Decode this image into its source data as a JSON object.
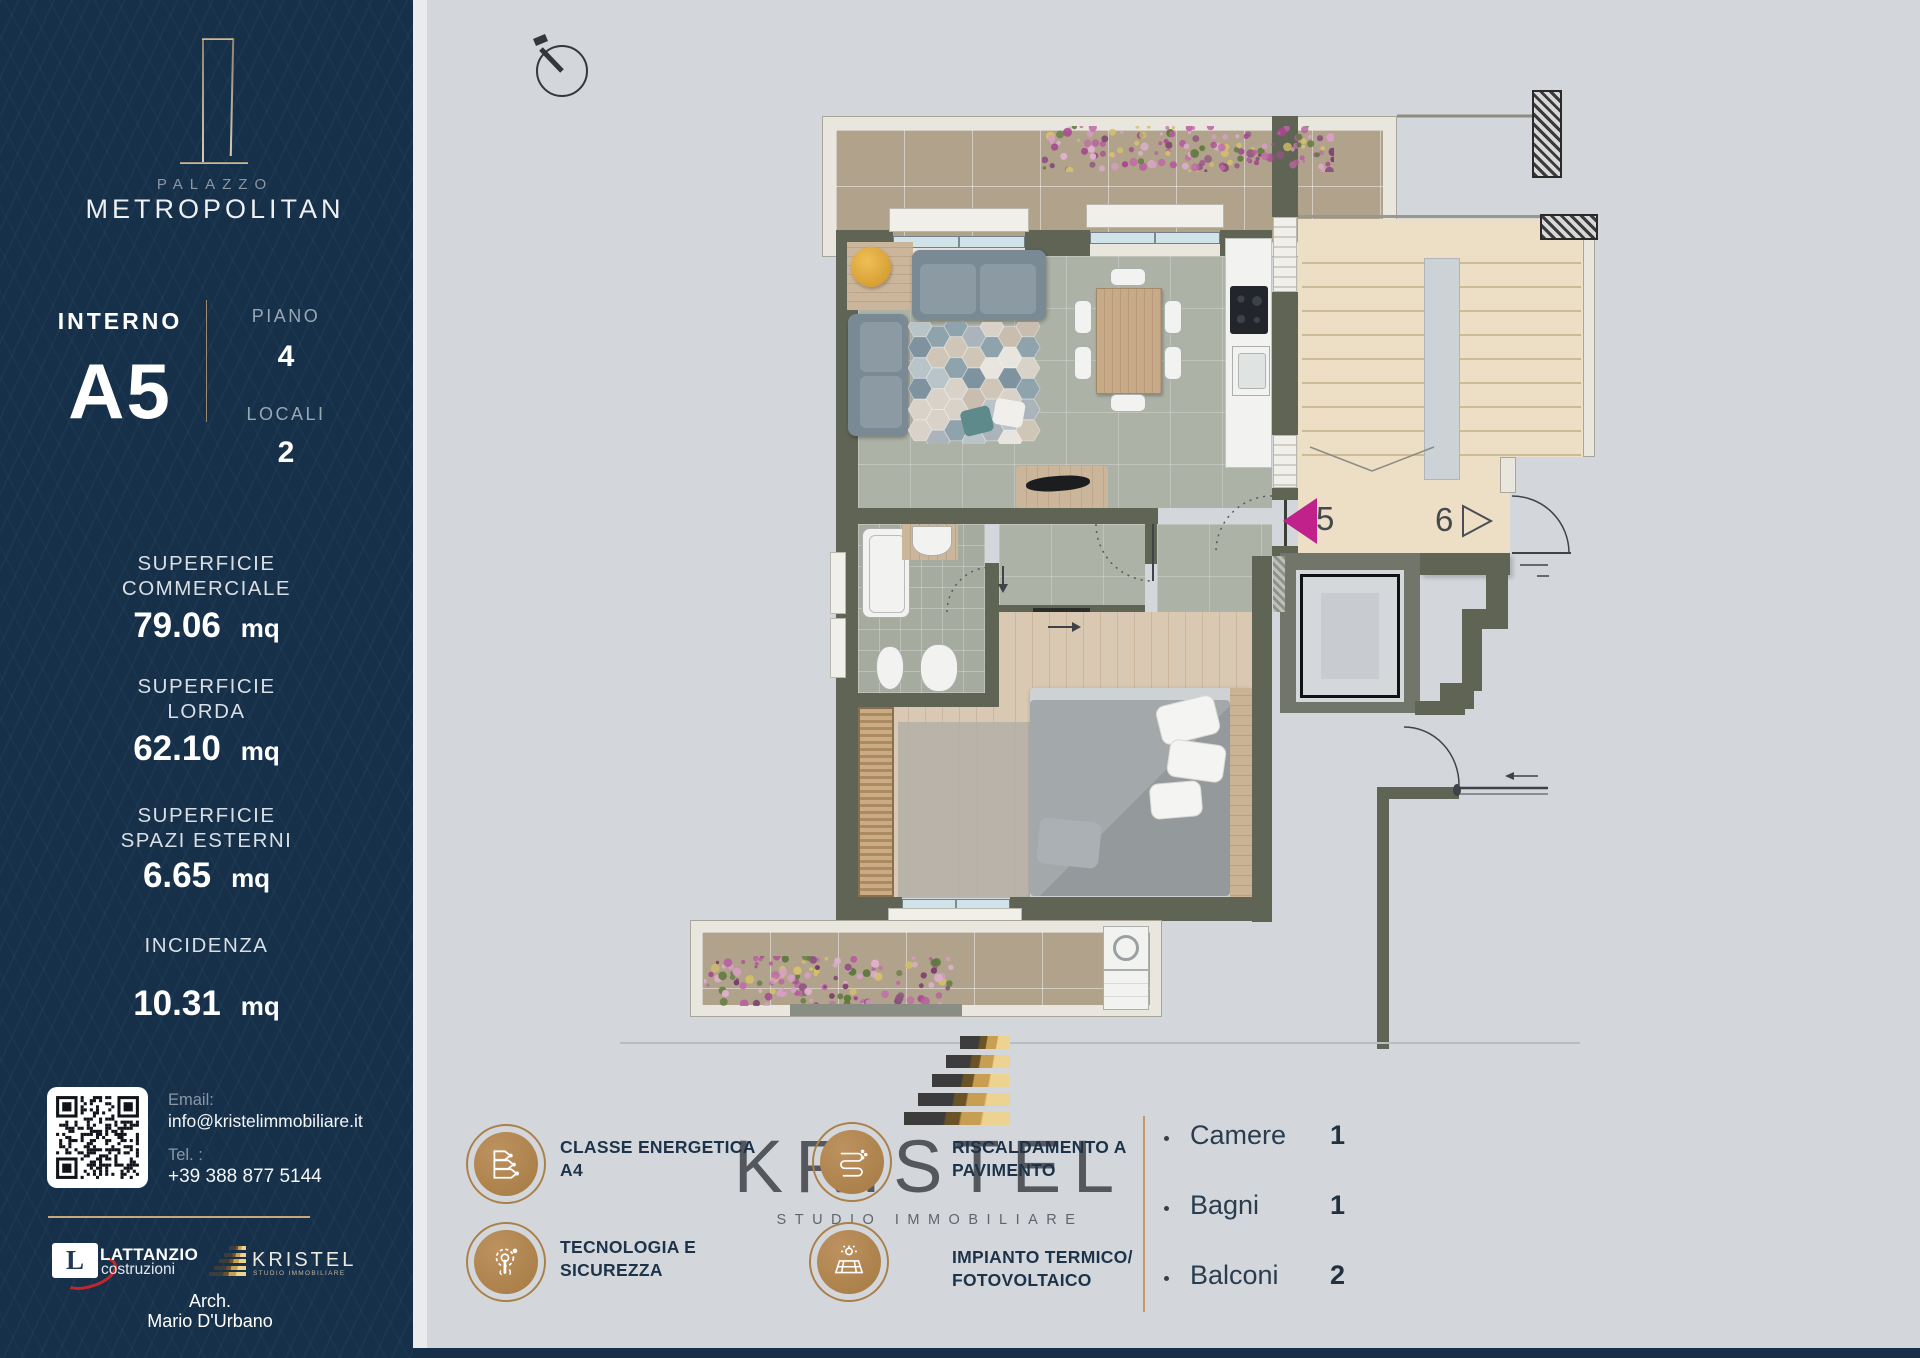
{
  "sidebar": {
    "brand": {
      "palazzo": "PALAZZO",
      "name": "METROPOLITAN"
    },
    "unit": {
      "interno_label": "INTERNO",
      "interno_value": "A5",
      "piano_label": "PIANO",
      "piano_value": "4",
      "locali_label": "LOCALI",
      "locali_value": "2"
    },
    "metrics": [
      {
        "label_line1": "SUPERFICIE",
        "label_line2": "COMMERCIALE",
        "value": "79.06",
        "unit": "mq"
      },
      {
        "label_line1": "SUPERFICIE",
        "label_line2": "LORDA",
        "value": "62.10",
        "unit": "mq"
      },
      {
        "label_line1": "SUPERFICIE",
        "label_line2": "SPAZI ESTERNI",
        "value": "6.65",
        "unit": "mq"
      },
      {
        "label_line1": "INCIDENZA",
        "label_line2": "CONDOMINIALE",
        "value": "10.31",
        "unit": "mq"
      }
    ],
    "contact": {
      "email_label": "Email:",
      "email": "info@kristelimmobiliare.it",
      "tel_label": "Tel. :",
      "tel": "+39 388 877 5144"
    },
    "partners": {
      "lattanzio_initial": "L",
      "lattanzio_name": "LATTANZIO",
      "lattanzio_sub": "costruzioni",
      "kristel_name": "KRISTEL",
      "kristel_sub": "STUDIO IMMOBILIARE"
    },
    "architect": {
      "line1": "Arch.",
      "line2": "Mario D'Urbano"
    }
  },
  "plan": {
    "markers": [
      {
        "id": "5"
      },
      {
        "id": "6"
      }
    ]
  },
  "footer": {
    "features": [
      {
        "icon": "energy-class-icon",
        "line1": "CLASSE ENERGETICA",
        "line2": "A4"
      },
      {
        "icon": "technology-security-icon",
        "line1": "TECNOLOGIA E",
        "line2": "SICUREZZA"
      },
      {
        "icon": "floor-heating-icon",
        "line1": "RISCALDAMENTO A",
        "line2": "PAVIMENTO"
      },
      {
        "icon": "solar-icon",
        "line1": "IMPIANTO TERMICO/",
        "line2": "FOTOVOLTAICO"
      }
    ],
    "watermark": {
      "name": "KRISTEL",
      "sub": "STUDIO IMMOBILIARE"
    },
    "legend": [
      {
        "label": "Camere",
        "value": "1"
      },
      {
        "label": "Bagni",
        "value": "1"
      },
      {
        "label": "Balconi",
        "value": "2"
      }
    ]
  },
  "colors": {
    "navy": "#16304a",
    "gold": "#b5854f",
    "magenta": "#c0218a",
    "wall_olive": "#5f6455",
    "floor_gray": "#adb2a6",
    "balcony_beige": "#b1a28c",
    "stair_beige": "#ecdfc6",
    "content_gray": "#d3d7db"
  }
}
